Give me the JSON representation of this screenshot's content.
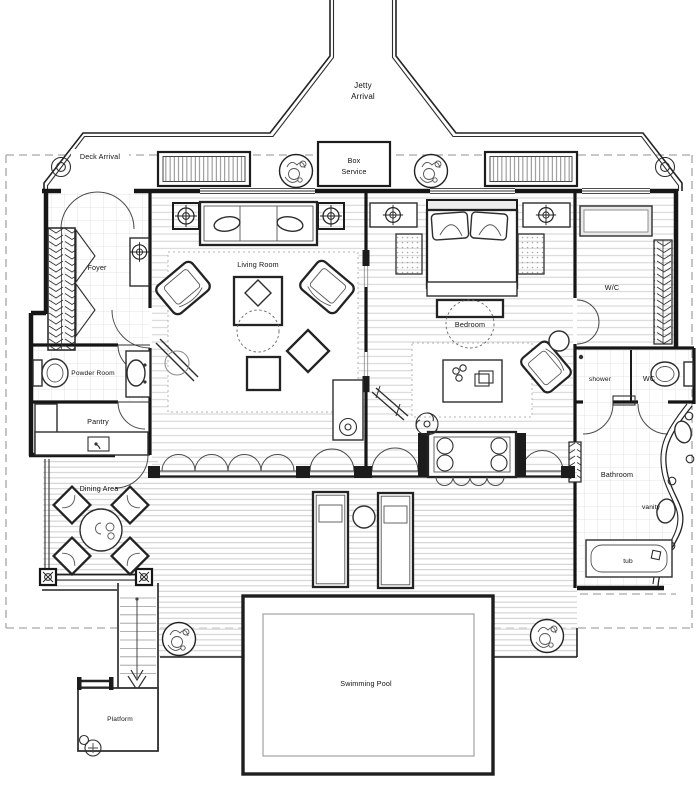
{
  "title": "Villa Floor Plan",
  "labels": {
    "jetty_l1": "Jetty",
    "jetty_l2": "Arrival",
    "deck_arrival": "Deck Arrival",
    "box_l1": "Box",
    "box_l2": "Service",
    "foyer": "Foyer",
    "living_room": "Living Room",
    "bedroom": "Bedroom",
    "wic": "W/C",
    "powder_room": "Powder Room",
    "shower": "shower",
    "wc": "WC",
    "pantry": "Pantry",
    "bathroom": "Bathroom",
    "vanity": "vanity",
    "dining_area": "Dining Area",
    "tub": "tub",
    "swimming_pool": "Swimming Pool",
    "platform": "Platform"
  },
  "colors": {
    "wall": "#161616",
    "furniture": "#2e2e2e",
    "plank": "#c9c9c9",
    "tile": "#dcdcdc",
    "boundary_dash": "#a6a6a6",
    "label": "#111111",
    "paper": "#ffffff"
  }
}
